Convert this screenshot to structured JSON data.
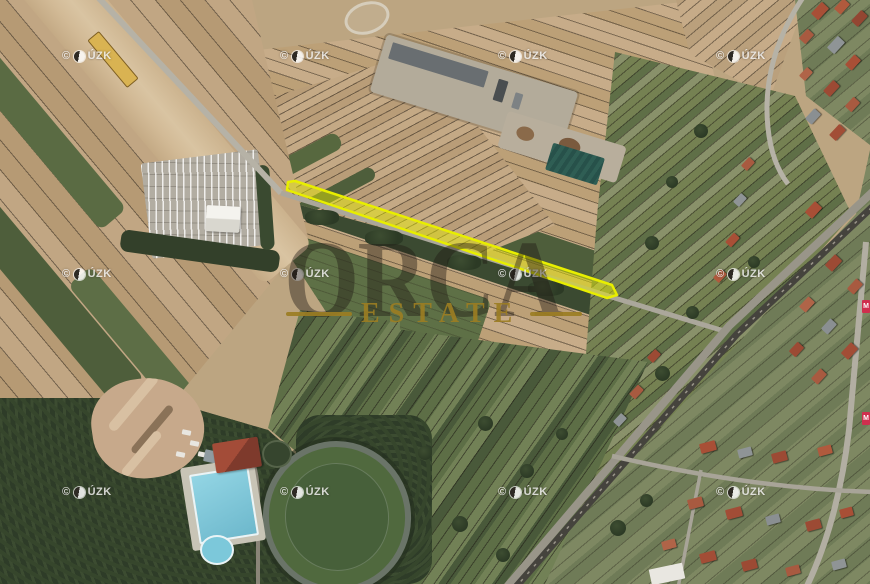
{
  "map": {
    "provider": {
      "copyright": "©",
      "org": "ÚZK",
      "full_label": "© ČÚZK"
    },
    "brand_watermark": {
      "name": "ORCA",
      "subtitle": "ESTATE",
      "subtitle_color": "#9b7d23"
    },
    "highlighted_parcel": {
      "outline_color": "#e8ee00",
      "fill_color": "rgba(238,242,0,0.45)"
    },
    "edge_labels": {
      "upper": "M",
      "lower": "M"
    },
    "palette": {
      "field_tan": "#c2a783",
      "field_green": "#5e7046",
      "woodland": "#2e3c28",
      "road": "#b6b2a6",
      "railway": "#45433d",
      "pool_blue": "#7cc8da",
      "roof_red": "#a84f36"
    }
  }
}
